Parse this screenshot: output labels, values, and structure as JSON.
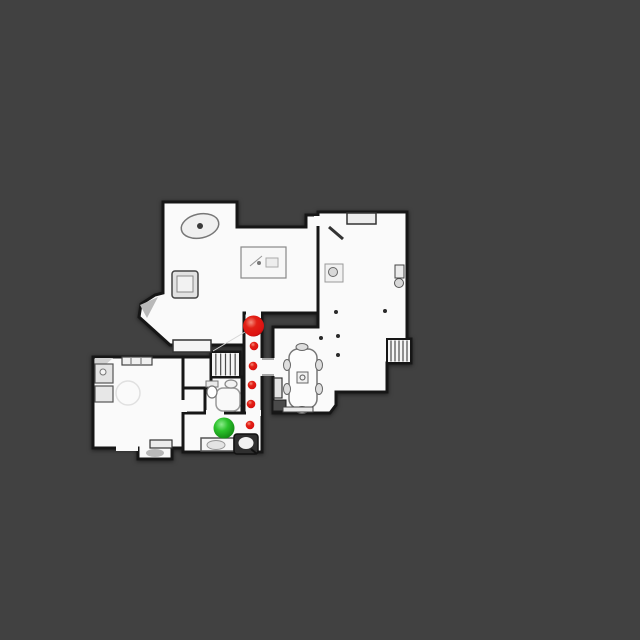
{
  "scene": {
    "background_color": "#414141",
    "floor_color": "#FAFAFA",
    "wall_color": "#161616",
    "wall_width": 3
  },
  "markers": [
    {
      "name": "red-path-marker-large",
      "kind": "large-red-sphere",
      "color": "red",
      "x": 253.5,
      "y": 326,
      "r": 10.5
    },
    {
      "name": "red-waypoint-dot-1",
      "kind": "small-red-sphere",
      "color": "red",
      "x": 254,
      "y": 346,
      "r": 4.3
    },
    {
      "name": "red-waypoint-dot-2",
      "kind": "small-red-sphere",
      "color": "red",
      "x": 253,
      "y": 366,
      "r": 4.3
    },
    {
      "name": "red-waypoint-dot-3",
      "kind": "small-red-sphere",
      "color": "red",
      "x": 252,
      "y": 385,
      "r": 4.3
    },
    {
      "name": "red-waypoint-dot-4",
      "kind": "small-red-sphere",
      "color": "red",
      "x": 251,
      "y": 404,
      "r": 4.3
    },
    {
      "name": "red-waypoint-dot-5",
      "kind": "small-red-sphere",
      "color": "red",
      "x": 250,
      "y": 425,
      "r": 4.3
    },
    {
      "name": "green-position-marker",
      "kind": "large-green-sphere",
      "color": "green",
      "x": 224,
      "y": 428,
      "r": 10.5
    }
  ],
  "marker_colors": {
    "red_body": "#DD1111",
    "red_highlight": "#F58B7B",
    "red_edge": "#8F0707",
    "green_body": "#2CC32C",
    "green_highlight": "#8BEB8B",
    "green_edge": "#0E7C0E"
  },
  "floorplan": {
    "rooms": [
      {
        "name": "room-living",
        "shape": "polygon",
        "points": [
          [
            163,
            202
          ],
          [
            237,
            202
          ],
          [
            237,
            227
          ],
          [
            306,
            227
          ],
          [
            306,
            215
          ],
          [
            318,
            215
          ],
          [
            318,
            313
          ],
          [
            244,
            313
          ],
          [
            244,
            345
          ],
          [
            170,
            345
          ],
          [
            139,
            317
          ],
          [
            141,
            304
          ],
          [
            155,
            295
          ],
          [
            163,
            293
          ]
        ]
      },
      {
        "name": "room-great-dining",
        "shape": "polygon",
        "points": [
          [
            318,
            212
          ],
          [
            407,
            212
          ],
          [
            407,
            339
          ],
          [
            411,
            339
          ],
          [
            411,
            363
          ],
          [
            387,
            363
          ],
          [
            387,
            392
          ],
          [
            336,
            392
          ],
          [
            336,
            405
          ],
          [
            330,
            413
          ],
          [
            273,
            413
          ],
          [
            273,
            327
          ],
          [
            318,
            327
          ]
        ]
      },
      {
        "name": "room-corridor",
        "shape": "rect",
        "x": 244,
        "y": 313,
        "w": 18,
        "h": 139
      },
      {
        "name": "room-stairwell",
        "shape": "rect",
        "x": 211,
        "y": 352,
        "w": 29,
        "h": 25
      },
      {
        "name": "room-bathroom",
        "shape": "rect",
        "x": 203,
        "y": 377,
        "w": 39,
        "h": 36
      },
      {
        "name": "room-closet",
        "shape": "rect",
        "x": 183,
        "y": 388,
        "w": 22,
        "h": 25
      },
      {
        "name": "room-landing",
        "shape": "rect",
        "x": 183,
        "y": 357,
        "w": 28,
        "h": 31
      },
      {
        "name": "room-entry-hall",
        "shape": "rect",
        "x": 183,
        "y": 413,
        "w": 79,
        "h": 39
      },
      {
        "name": "room-bedroom",
        "shape": "polygon",
        "points": [
          [
            93,
            357
          ],
          [
            183,
            357
          ],
          [
            183,
            448
          ],
          [
            172,
            448
          ],
          [
            172,
            459
          ],
          [
            138,
            459
          ],
          [
            138,
            448
          ],
          [
            93,
            448
          ]
        ]
      }
    ],
    "door_openings": [
      {
        "name": "door-living-corridor",
        "x": 246,
        "y": 309,
        "w": 15,
        "h": 9
      },
      {
        "name": "door-corridor-entry",
        "x": 246,
        "y": 410,
        "w": 15,
        "h": 6
      },
      {
        "name": "door-entry-junction",
        "x": 241,
        "y": 416,
        "w": 6,
        "h": 33
      },
      {
        "name": "door-corridor-dining",
        "x": 260,
        "y": 358,
        "w": 16,
        "h": 18
      },
      {
        "name": "door-living-greatroom",
        "x": 314,
        "y": 216,
        "w": 9,
        "h": 10
      },
      {
        "name": "door-bathroom-entry",
        "x": 206,
        "y": 410,
        "w": 18,
        "h": 6
      },
      {
        "name": "door-bedroom-closet",
        "x": 180,
        "y": 400,
        "w": 7,
        "h": 12
      },
      {
        "name": "door-bedroom-south",
        "x": 116,
        "y": 444,
        "w": 22,
        "h": 7
      }
    ],
    "thresholds": [
      {
        "name": "threshold-dining-top",
        "x1": 262,
        "y1": 359,
        "x2": 274,
        "y2": 359
      },
      {
        "name": "threshold-dining-bottom",
        "x1": 262,
        "y1": 375,
        "x2": 274,
        "y2": 375
      }
    ],
    "stair_runs": [
      {
        "name": "stairs-middle",
        "x": 211,
        "y": 352,
        "w": 29,
        "h": 25,
        "treads": 6
      },
      {
        "name": "stairs-east",
        "x": 387,
        "y": 339,
        "w": 24,
        "h": 24,
        "treads": 6
      }
    ],
    "furniture": [
      {
        "name": "round-table",
        "shape": "ellipse",
        "cx": 200,
        "cy": 226,
        "rx": 19,
        "ry": 12,
        "rot": [
          -12,
          200,
          226
        ],
        "fill": "#F0F0F0",
        "stroke": "#777777",
        "sw": 1.5
      },
      {
        "name": "round-table-pedestal",
        "shape": "circle",
        "cx": 200,
        "cy": 226,
        "r": 3,
        "fill": "#3A3A3A"
      },
      {
        "name": "area-rug",
        "shape": "rect",
        "x": 241,
        "y": 247,
        "w": 45,
        "h": 31,
        "fill": "#F7F7F7",
        "stroke": "#888888",
        "sw": 1.2
      },
      {
        "name": "rug-sketch-line",
        "shape": "line",
        "x1": 250,
        "y1": 266,
        "x2": 262,
        "y2": 256,
        "stroke": "#999999",
        "sw": 1
      },
      {
        "name": "rug-sketch-dot",
        "shape": "circle",
        "cx": 259,
        "cy": 263,
        "r": 2,
        "fill": "#777777"
      },
      {
        "name": "rug-sketch-box",
        "shape": "rect",
        "x": 266,
        "y": 258,
        "w": 12,
        "h": 9,
        "fill": "#EDEDED",
        "stroke": "#AAAAAA",
        "sw": 1
      },
      {
        "name": "armchair",
        "shape": "rect",
        "x": 172,
        "y": 271,
        "w": 26,
        "h": 27,
        "rx": 3,
        "fill": "#E2E2E2",
        "stroke": "#444444",
        "sw": 1.5
      },
      {
        "name": "armchair-cushion",
        "shape": "rect",
        "x": 177,
        "y": 276,
        "w": 16,
        "h": 16,
        "fill": "#F2F2F2",
        "stroke": "#888888",
        "sw": 1
      },
      {
        "name": "tv-console",
        "shape": "rect",
        "x": -14,
        "y": -9,
        "w": 28,
        "h": 18,
        "rot": [
          32,
          207,
          306
        ],
        "fill": "#D2D2D2",
        "stroke": "#333333",
        "sw": 1.5
      },
      {
        "name": "tv-screen",
        "shape": "rect",
        "x": -10,
        "y": -5,
        "w": 20,
        "h": 11,
        "rot": [
          32,
          207,
          306
        ],
        "fill": "#EFEFEF",
        "stroke": "#555555",
        "sw": 1
      },
      {
        "name": "window-bench",
        "shape": "rect",
        "x": 173,
        "y": 340,
        "w": 38,
        "h": 12,
        "fill": "#F4F4F4",
        "stroke": "#333333",
        "sw": 1.5
      },
      {
        "name": "bay-cabinet",
        "shape": "rect",
        "x": -7,
        "y": -8,
        "w": 14,
        "h": 16,
        "rot": [
          -43,
          148,
          337
        ],
        "fill": "#EFEFEF",
        "stroke": "#222222",
        "sw": 1.5
      },
      {
        "name": "bay-shading",
        "shape": "polygon",
        "points": [
          [
            140,
            305
          ],
          [
            158,
            297
          ],
          [
            147,
            318
          ]
        ],
        "fill": "#B9B9B9"
      },
      {
        "name": "floor-seam",
        "shape": "line",
        "x1": 213,
        "y1": 351,
        "x2": 250,
        "y2": 329,
        "stroke": "#D5D5D5",
        "sw": 1
      },
      {
        "name": "alcove-shelf",
        "shape": "rect",
        "x": 347,
        "y": 213,
        "w": 29,
        "h": 11,
        "fill": "#ECECEC",
        "stroke": "#333333",
        "sw": 1.5
      },
      {
        "name": "wall-shelf-diagonal",
        "shape": "line",
        "x1": 329,
        "y1": 227,
        "x2": 343,
        "y2": 239,
        "stroke": "#333333",
        "sw": 3
      },
      {
        "name": "chair-northwest",
        "shape": "rect",
        "x": -6.5,
        "y": -6.5,
        "w": 13,
        "h": 13,
        "rot": [
          40,
          340,
          250
        ],
        "fill": "#DCDCDC",
        "stroke": "#333333",
        "sw": 1.5
      },
      {
        "name": "chair-northeast",
        "shape": "rect",
        "x": -6.5,
        "y": -6.5,
        "w": 13,
        "h": 13,
        "rot": [
          35,
          392,
          237
        ],
        "fill": "#DCDCDC",
        "stroke": "#333333",
        "sw": 1.5
      },
      {
        "name": "chair-southwest",
        "shape": "rect",
        "x": -6.5,
        "y": -6.5,
        "w": 13,
        "h": 13,
        "rot": [
          25,
          339,
          291
        ],
        "fill": "#DCDCDC",
        "stroke": "#333333",
        "sw": 1.5
      },
      {
        "name": "side-table",
        "shape": "rect",
        "x": 325,
        "y": 264,
        "w": 18,
        "h": 18,
        "fill": "#F1F1F1",
        "stroke": "#999999",
        "sw": 1
      },
      {
        "name": "side-table-vase",
        "shape": "circle",
        "cx": 333,
        "cy": 272,
        "r": 4.5,
        "fill": "#D8D8D8",
        "stroke": "#666666",
        "sw": 1
      },
      {
        "name": "desk",
        "shape": "rect",
        "x": -21,
        "y": -13,
        "w": 42,
        "h": 26,
        "rot": [
          -35,
          382,
          291
        ],
        "fill": "#CCCCCC",
        "stroke": "#222222",
        "sw": 1.5
      },
      {
        "name": "desk-top",
        "shape": "rect",
        "x": -17,
        "y": -9,
        "w": 34,
        "h": 18,
        "rot": [
          -35,
          382,
          291
        ],
        "fill": "#E5E5E5",
        "stroke": "#777777",
        "sw": 1
      },
      {
        "name": "desk-stool",
        "shape": "circle",
        "cx": 399,
        "cy": 283,
        "r": 4.5,
        "fill": "#D8D8D8",
        "stroke": "#555555",
        "sw": 1
      },
      {
        "name": "radiator",
        "shape": "rect",
        "x": 395,
        "y": 265,
        "w": 9,
        "h": 13,
        "fill": "#EBEBEB",
        "stroke": "#444444",
        "sw": 1
      },
      {
        "name": "floor-dot-1",
        "shape": "circle",
        "cx": 336,
        "cy": 312,
        "r": 2,
        "fill": "#2A2A2A"
      },
      {
        "name": "floor-dot-2",
        "shape": "circle",
        "cx": 385,
        "cy": 311,
        "r": 2,
        "fill": "#2A2A2A"
      },
      {
        "name": "floor-dot-3",
        "shape": "circle",
        "cx": 321,
        "cy": 338,
        "r": 2,
        "fill": "#2A2A2A"
      },
      {
        "name": "floor-dot-4",
        "shape": "circle",
        "cx": 338,
        "cy": 336,
        "r": 2,
        "fill": "#2A2A2A"
      },
      {
        "name": "floor-dot-5",
        "shape": "circle",
        "cx": 338,
        "cy": 355,
        "r": 2,
        "fill": "#2A2A2A"
      },
      {
        "name": "dining-table",
        "shape": "rect",
        "x": 289,
        "y": 349,
        "w": 28,
        "h": 59,
        "rx": 9,
        "fill": "#FCFCFC",
        "stroke": "#777777",
        "sw": 1.5
      },
      {
        "name": "centerpiece-tray",
        "shape": "rect",
        "x": 297,
        "y": 372,
        "w": 11,
        "h": 11,
        "fill": "#F0F0F0",
        "stroke": "#666666",
        "sw": 1
      },
      {
        "name": "centerpiece-bowl",
        "shape": "circle",
        "cx": 302.5,
        "cy": 377.5,
        "r": 2.5,
        "fill": "none",
        "stroke": "#555555",
        "sw": 1
      },
      {
        "name": "dining-chair-north",
        "shape": "ellipse",
        "cx": 302,
        "cy": 347,
        "rx": 6,
        "ry": 3.5,
        "fill": "#DEDEDE",
        "stroke": "#666666",
        "sw": 1
      },
      {
        "name": "dining-chair-south",
        "shape": "ellipse",
        "cx": 302,
        "cy": 410,
        "rx": 6,
        "ry": 3.5,
        "fill": "#DEDEDE",
        "stroke": "#666666",
        "sw": 1
      },
      {
        "name": "dining-chair-west1",
        "shape": "ellipse",
        "cx": 287,
        "cy": 365,
        "rx": 3.5,
        "ry": 5.5,
        "fill": "#DEDEDE",
        "stroke": "#666666",
        "sw": 1
      },
      {
        "name": "dining-chair-west2",
        "shape": "ellipse",
        "cx": 287,
        "cy": 389,
        "rx": 3.5,
        "ry": 5.5,
        "fill": "#DEDEDE",
        "stroke": "#666666",
        "sw": 1
      },
      {
        "name": "dining-chair-east1",
        "shape": "ellipse",
        "cx": 319,
        "cy": 365,
        "rx": 3.5,
        "ry": 5.5,
        "fill": "#DEDEDE",
        "stroke": "#666666",
        "sw": 1
      },
      {
        "name": "dining-chair-east2",
        "shape": "ellipse",
        "cx": 319,
        "cy": 389,
        "rx": 3.5,
        "ry": 5.5,
        "fill": "#DEDEDE",
        "stroke": "#666666",
        "sw": 1
      },
      {
        "name": "sideboard",
        "shape": "rect",
        "x": 274,
        "y": 378,
        "w": 8,
        "h": 20,
        "fill": "#E4E4E4",
        "stroke": "#333333",
        "sw": 1.2
      },
      {
        "name": "dark-cabinet",
        "shape": "rect",
        "x": 273,
        "y": 400,
        "w": 13,
        "h": 11,
        "fill": "#4A4A4A",
        "stroke": "#1A1A1A",
        "sw": 1
      },
      {
        "name": "dining-bench",
        "shape": "rect",
        "x": 283,
        "y": 407,
        "w": 30,
        "h": 5,
        "fill": "#E9E9E9",
        "stroke": "#444444",
        "sw": 1
      },
      {
        "name": "bathtub",
        "shape": "rect",
        "x": 216,
        "y": 388,
        "w": 24,
        "h": 23,
        "rx": 7,
        "fill": "#F9F9F9",
        "stroke": "#999999",
        "sw": 1.5
      },
      {
        "name": "toilet-tank",
        "shape": "rect",
        "x": 206,
        "y": 381,
        "w": 12,
        "h": 6,
        "fill": "#EAEAEA",
        "stroke": "#777777",
        "sw": 1
      },
      {
        "name": "toilet-bowl",
        "shape": "ellipse",
        "cx": 212,
        "cy": 392,
        "rx": 5,
        "ry": 6,
        "fill": "#FFFFFF",
        "stroke": "#777777",
        "sw": 1.2
      },
      {
        "name": "bathroom-sink",
        "shape": "ellipse",
        "cx": 231,
        "cy": 384,
        "rx": 6,
        "ry": 4,
        "fill": "#F2F2F2",
        "stroke": "#888888",
        "sw": 1.2
      },
      {
        "name": "kitchen-corner-counter",
        "shape": "polygon",
        "points": [
          [
            95,
            358
          ],
          [
            113,
            358
          ],
          [
            95,
            374
          ]
        ],
        "fill": "#D2D2D2"
      },
      {
        "name": "kitchen-counter-1",
        "shape": "rect",
        "x": 95,
        "y": 364,
        "w": 18,
        "h": 19,
        "fill": "#E3E3E3",
        "stroke": "#555555",
        "sw": 1.2
      },
      {
        "name": "kitchen-counter-2",
        "shape": "rect",
        "x": 95,
        "y": 386,
        "w": 18,
        "h": 16,
        "fill": "#E7E7E7",
        "stroke": "#555555",
        "sw": 1.2
      },
      {
        "name": "kitchen-sink",
        "shape": "circle",
        "cx": 103,
        "cy": 372,
        "r": 3,
        "fill": "#F5F5F5",
        "stroke": "#777777",
        "sw": 1
      },
      {
        "name": "window-shelf",
        "shape": "rect",
        "x": 122,
        "y": 357,
        "w": 30,
        "h": 8,
        "fill": "#F0F0F0",
        "stroke": "#444444",
        "sw": 1.2
      },
      {
        "name": "window-tick-1",
        "shape": "line",
        "x1": 131,
        "y1": 358,
        "x2": 131,
        "y2": 364,
        "stroke": "#666666",
        "sw": 1
      },
      {
        "name": "window-tick-2",
        "shape": "line",
        "x1": 141,
        "y1": 358,
        "x2": 141,
        "y2": 364,
        "stroke": "#666666",
        "sw": 1
      },
      {
        "name": "faint-round-table",
        "shape": "circle",
        "cx": 128,
        "cy": 393,
        "r": 12,
        "fill": "none",
        "stroke": "#E0E0E0",
        "sw": 1.5
      },
      {
        "name": "door-step",
        "shape": "rect",
        "x": 150,
        "y": 440,
        "w": 22,
        "h": 8,
        "fill": "#ECECEC",
        "stroke": "#333333",
        "sw": 1.2
      },
      {
        "name": "alcove-mat",
        "shape": "ellipse",
        "cx": 155,
        "cy": 453,
        "rx": 9,
        "ry": 4,
        "fill": "#B9B9B9"
      },
      {
        "name": "entry-bench",
        "shape": "rect",
        "x": 201,
        "y": 438,
        "w": 33,
        "h": 13,
        "fill": "#F6F6F6",
        "stroke": "#555555",
        "sw": 1.5
      },
      {
        "name": "entry-bench-cushion",
        "shape": "ellipse",
        "cx": 216,
        "cy": 445,
        "rx": 9,
        "ry": 4.5,
        "fill": "#E3E3E3",
        "stroke": "#999999",
        "sw": 1
      },
      {
        "name": "entry-armchair-dark",
        "shape": "rect",
        "x": 234,
        "y": 434,
        "w": 24,
        "h": 20,
        "rx": 3,
        "fill": "#2F2F2F",
        "stroke": "#111111",
        "sw": 1.5
      },
      {
        "name": "entry-armchair-seat",
        "shape": "ellipse",
        "cx": 246,
        "cy": 443,
        "rx": 7.5,
        "ry": 6,
        "fill": "#F1F1F1"
      },
      {
        "name": "entry-armchair-arm",
        "shape": "line",
        "x1": 251,
        "y1": 449,
        "x2": 257,
        "y2": 454,
        "stroke": "#111111",
        "sw": 2
      }
    ]
  }
}
